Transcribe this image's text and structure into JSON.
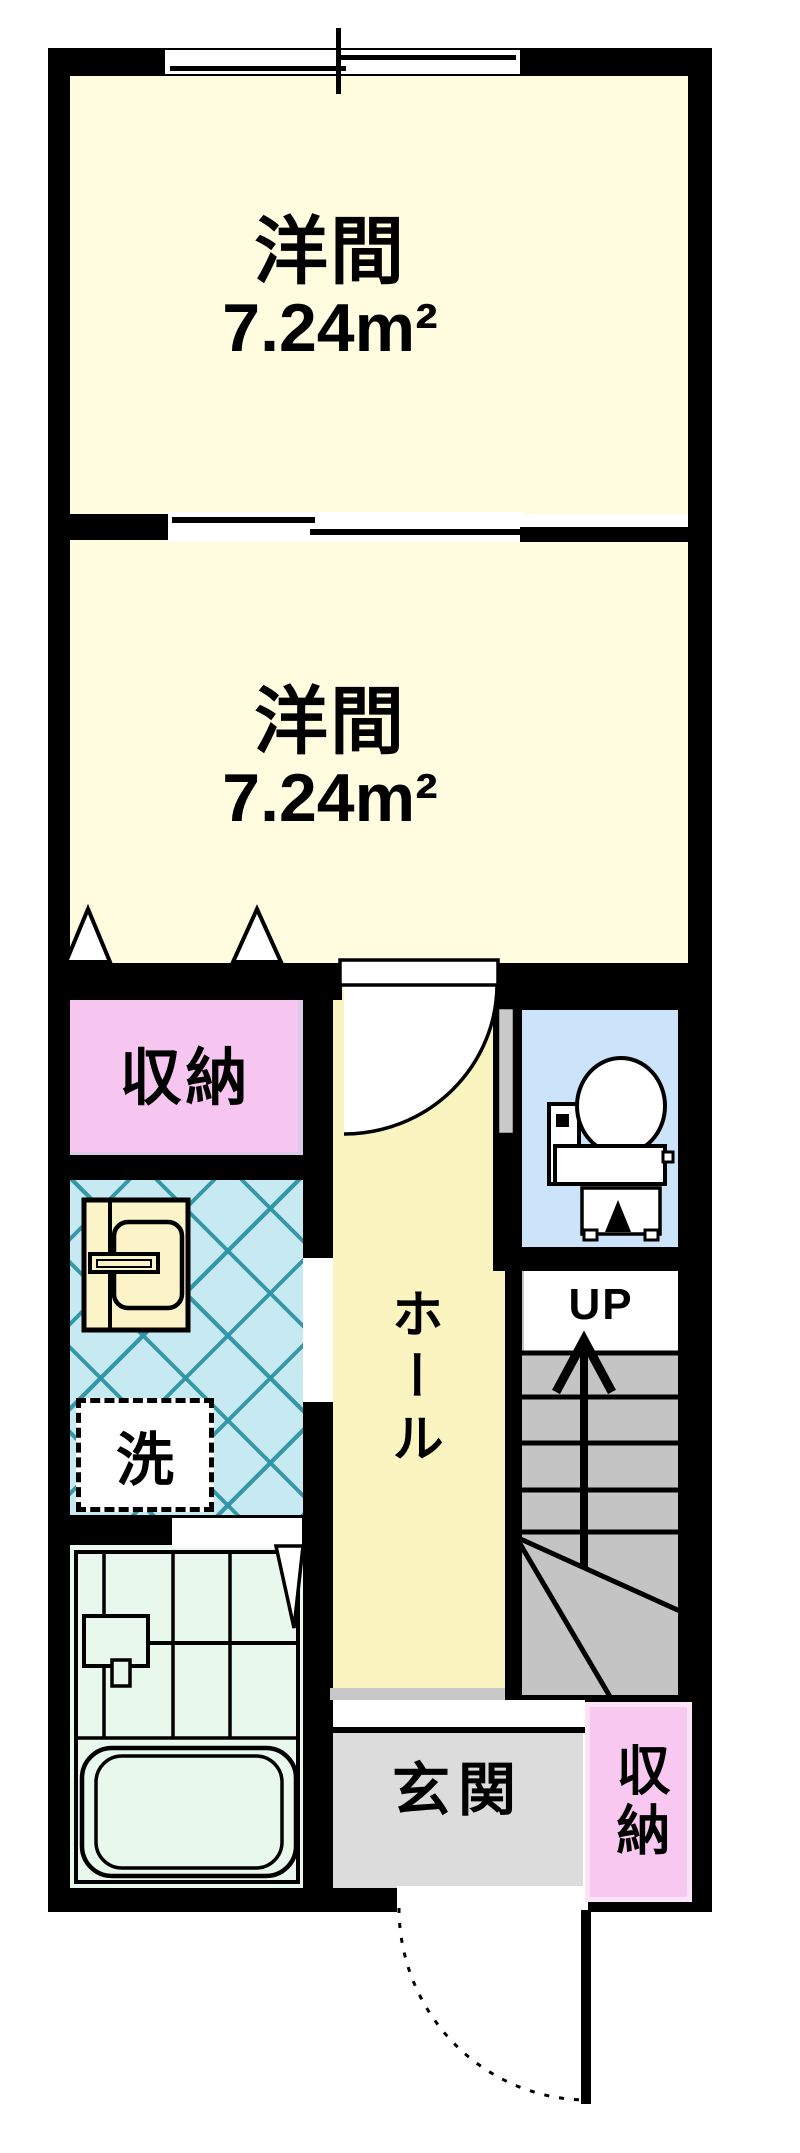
{
  "plan": {
    "type": "apartment-floor-plan",
    "rooms": {
      "room1": {
        "name": "洋間",
        "area": "7.24m²"
      },
      "room2": {
        "name": "洋間",
        "area": "7.24m²"
      },
      "closet_upper": {
        "label": "収納"
      },
      "hall": {
        "label": "ホール"
      },
      "washroom": {
        "laundry_label": "洗"
      },
      "stairs": {
        "label": "UP"
      },
      "entrance": {
        "label": "玄関"
      },
      "closet_lower": {
        "label": "収納"
      },
      "toilet": {
        "label": ""
      },
      "bath": {
        "label": ""
      }
    },
    "icons": {
      "window": "sliding-window-icon",
      "room_divider": "sliding-door-icon",
      "closet_doors": "folding-door-triangle-icon",
      "hall_door": "door-swing-icon",
      "toilet_door": "door-leaf-icon",
      "toilet": "toilet-plan-icon",
      "washbasin": "washbasin-icon",
      "laundry_pan": "washer-pan-icon",
      "bathtub": "bathtub-icon",
      "stairs_arrow": "up-arrow-icon",
      "entrance_door": "door-swing-icon"
    },
    "colors": {
      "wall": "#000000",
      "room_fill": "#FFFCE0",
      "hall_fill": "#F9F4C0",
      "closet_fill": "#F7C6F0",
      "closet_lower_fill": "#F8C8F0",
      "washroom_fill": "#C6E9F2",
      "washroom_lattice": "#2D93A4",
      "toilet_fill": "#CBE4F9",
      "bath_fill": "#E8F8EC",
      "entrance_fill": "#DCDCDC",
      "stairs_fill": "#C4C4C4"
    }
  }
}
